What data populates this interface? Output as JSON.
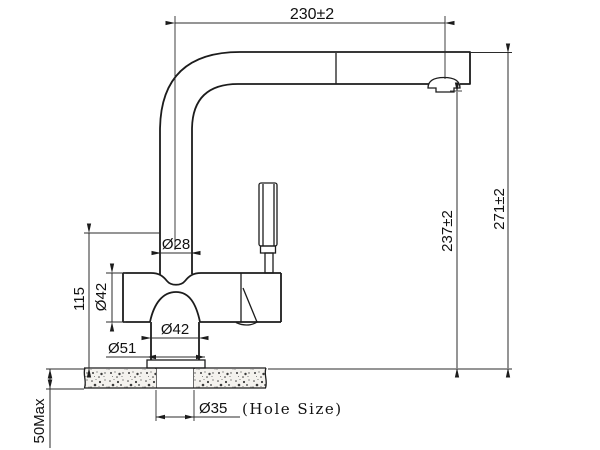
{
  "drawing": {
    "kind": "technical dimension drawing",
    "subject": "pull-out kitchen faucet, side elevation with countertop cross-section",
    "background_color": "#ffffff",
    "line_color": "#1c1c1c"
  },
  "dimensions": {
    "spout_reach": "230±2",
    "overall_height": "271±2",
    "outlet_height": "237±2",
    "body_height": "115",
    "column_diameter": "Ø28",
    "body_diameter": "Ø42",
    "base_diameter": "Ø42",
    "flange_diameter": "Ø51",
    "hole_diameter": "Ø35",
    "hole_note": "(Hole Size)",
    "counter_thickness": "50Max"
  }
}
